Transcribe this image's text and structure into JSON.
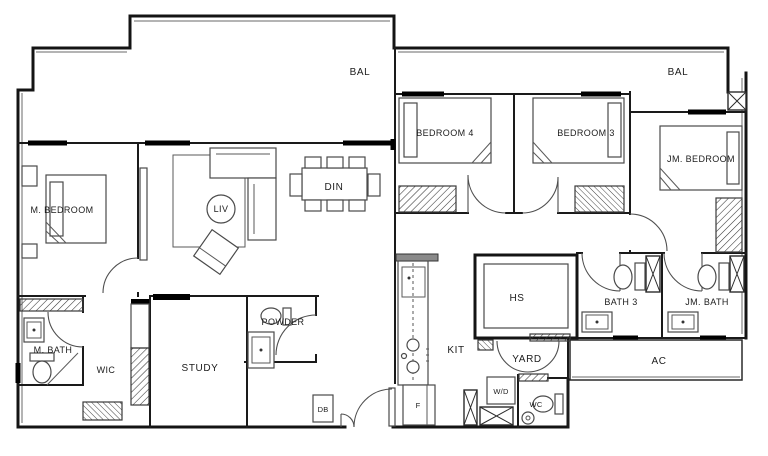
{
  "title": "Residential unit floor plan",
  "labels": {
    "bal_left": "BAL",
    "bal_right": "BAL",
    "m_bedroom": "M. BEDROOM",
    "liv": "LIV",
    "din": "DIN",
    "bedroom4": "BEDROOM 4",
    "bedroom3": "BEDROOM 3",
    "jm_bedroom": "JM. BEDROOM",
    "m_bath": "M. BATH",
    "wic": "WIC",
    "study": "STUDY",
    "powder": "POWDER",
    "kit": "KIT",
    "hs": "HS",
    "yard": "YARD",
    "bath3": "BATH 3",
    "jm_bath": "JM. BATH",
    "ac": "AC",
    "db": "DB",
    "fridge": "F",
    "washer_dryer": "W/D",
    "wc": "WC"
  },
  "colors": {
    "wall": "#141414",
    "furniture": "#4a4a4a",
    "background": "#ffffff"
  }
}
